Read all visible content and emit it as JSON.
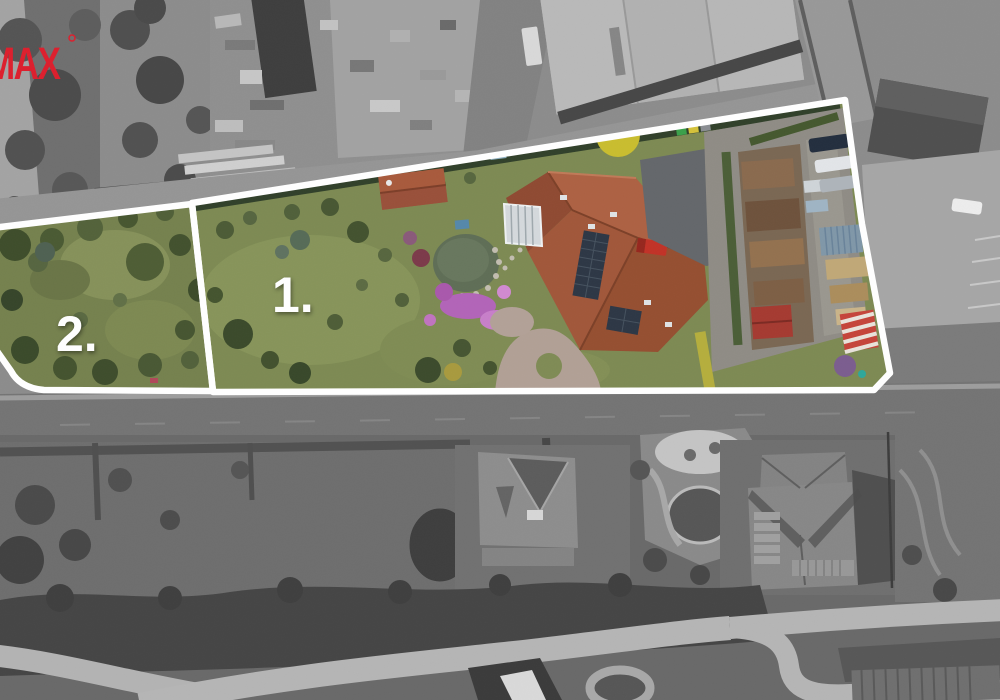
{
  "branding": {
    "logo_text": "MAX",
    "logo_color": "#DD1F2D"
  },
  "annotations": {
    "outline_color": "#FFFFFF",
    "label_color": "#FFFFFF",
    "parcels": [
      {
        "id": 1,
        "label": "1."
      },
      {
        "id": 2,
        "label": "2."
      }
    ]
  }
}
